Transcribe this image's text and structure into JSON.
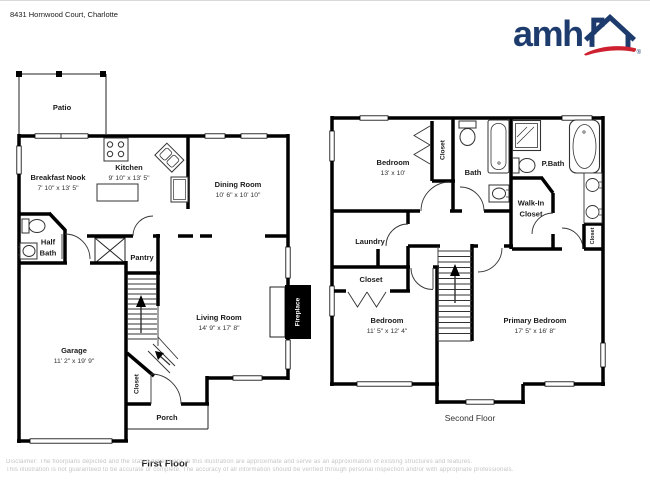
{
  "page": {
    "address": "8431 Hornwood Court, Charlotte"
  },
  "logo": {
    "text": "amh",
    "registered": "®"
  },
  "first_floor": {
    "caption": "First Floor",
    "patio": {
      "name": "Patio"
    },
    "breakfast_nook": {
      "name": "Breakfast Nook",
      "dims": "7' 10\" x 13' 5\""
    },
    "kitchen": {
      "name": "Kitchen",
      "dims": "9' 10\" x 13' 5\""
    },
    "dining_room": {
      "name": "Dining Room",
      "dims": "10' 6\" x 10' 10\""
    },
    "half_bath": {
      "name": "Half Bath"
    },
    "pantry": {
      "name": "Pantry"
    },
    "living_room": {
      "name": "Living Room",
      "dims": "14' 9\" x 17' 8\""
    },
    "fireplace": {
      "name": "Fireplace"
    },
    "garage": {
      "name": "Garage",
      "dims": "11' 2\" x 19' 9\""
    },
    "stair_closet": {
      "name": "Closet"
    },
    "porch": {
      "name": "Porch"
    }
  },
  "second_floor": {
    "caption": "Second Floor",
    "bedroom": {
      "name": "Bedroom",
      "dims": "13' x 10'"
    },
    "bedroom_closet": {
      "name": "Closet"
    },
    "bath": {
      "name": "Bath"
    },
    "primary_bath": {
      "name": "P.Bath"
    },
    "walk_in_closet": {
      "name": "Walk-In Closet"
    },
    "linen_closet": {
      "name": "Closet"
    },
    "laundry": {
      "name": "Laundry"
    },
    "hall_closet": {
      "name": "Closet"
    },
    "bedroom2": {
      "name": "Bedroom",
      "dims": "11' 5\" x 12' 4\""
    },
    "primary_bedroom": {
      "name": "Primary Bedroom",
      "dims": "17' 5\" x 16' 8\""
    }
  },
  "footer": {
    "disclaimer_line1": "Disclaimer: The floorplans depicted and the stated dimensions in this illustration are approximate and serve as an approximation of existing structures and features.",
    "disclaimer_line2": "This illustration is not guaranteed to be accurate or complete. The accuracy of all information should be verified through personal inspection and/or with appropriate professionals."
  },
  "colors": {
    "brand_navy": "#1d3c6d",
    "brand_red": "#cf202f",
    "wall": "#000000",
    "label": "#1a1a1a",
    "disclaimer": "#c4c4c4"
  }
}
